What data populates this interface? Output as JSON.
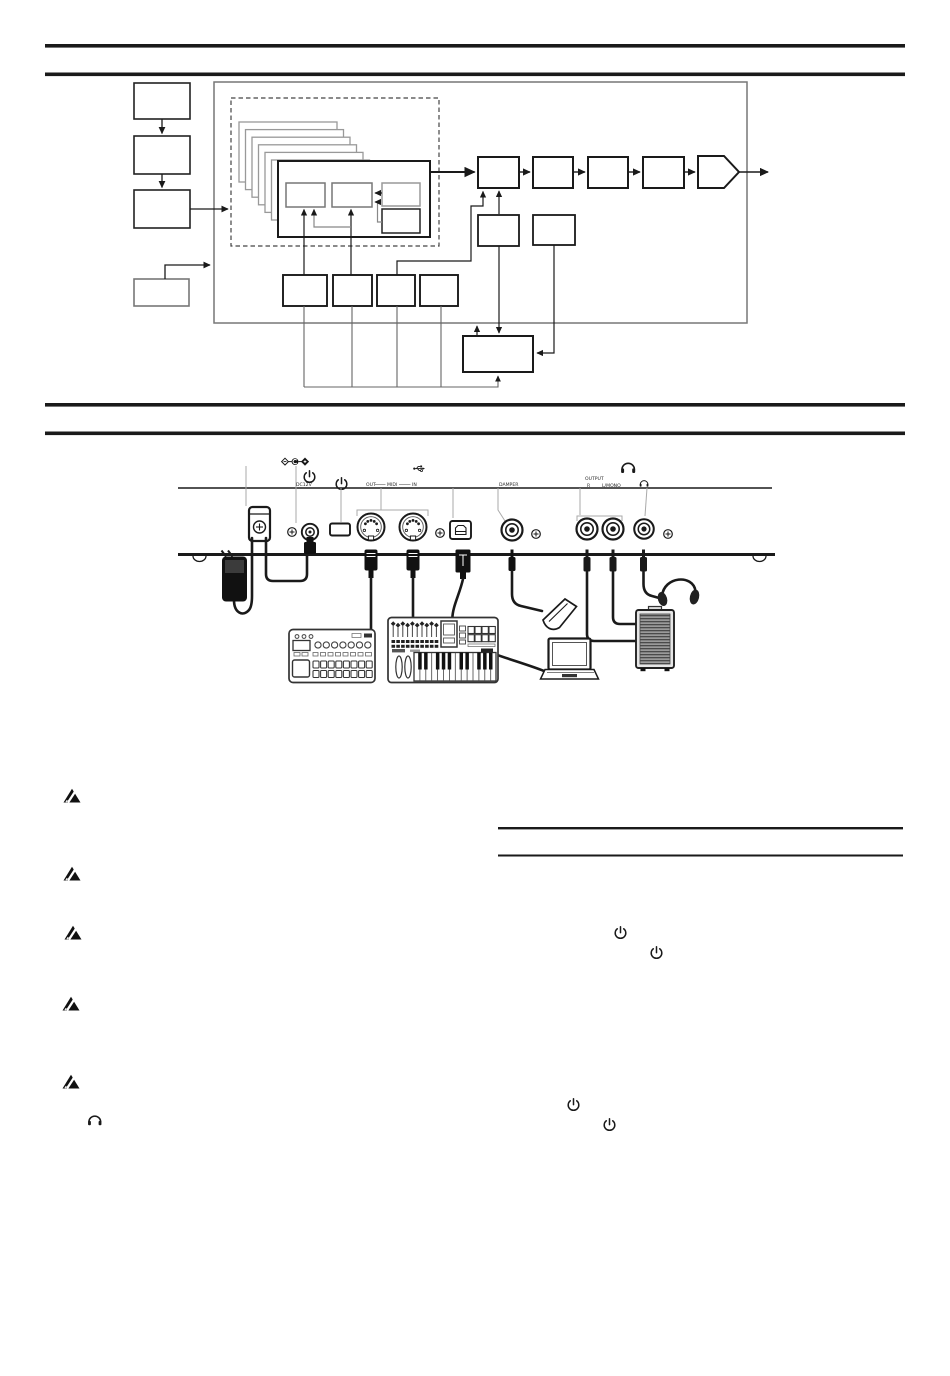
{
  "page": {
    "type": "scanned-manual-page",
    "ink_color": "#1a1a1a",
    "paper_color": "#ffffff"
  },
  "rear_panel": {
    "labels": {
      "dc": "DC12V",
      "midi_out": "OUT",
      "midi": "MIDI",
      "midi_in": "IN",
      "damper": "DAMPER",
      "output": "OUTPUT",
      "output_r": "R",
      "output_l_mono": "L/MONO"
    },
    "ports": [
      "dc-jack",
      "power-button",
      "midi-out",
      "midi-in",
      "usb-b",
      "damper-jack",
      "output-r-jack",
      "output-l-mono-jack",
      "headphones-jack"
    ],
    "connected_devices": [
      "ac-adapter",
      "groove-machine",
      "midi-keyboard-controller",
      "computer",
      "damper-pedal",
      "powered-monitor",
      "headphones"
    ]
  },
  "notes": {
    "caution_icon_count": 5,
    "power_icon_count": 4,
    "headphone_icon_count": 1
  }
}
